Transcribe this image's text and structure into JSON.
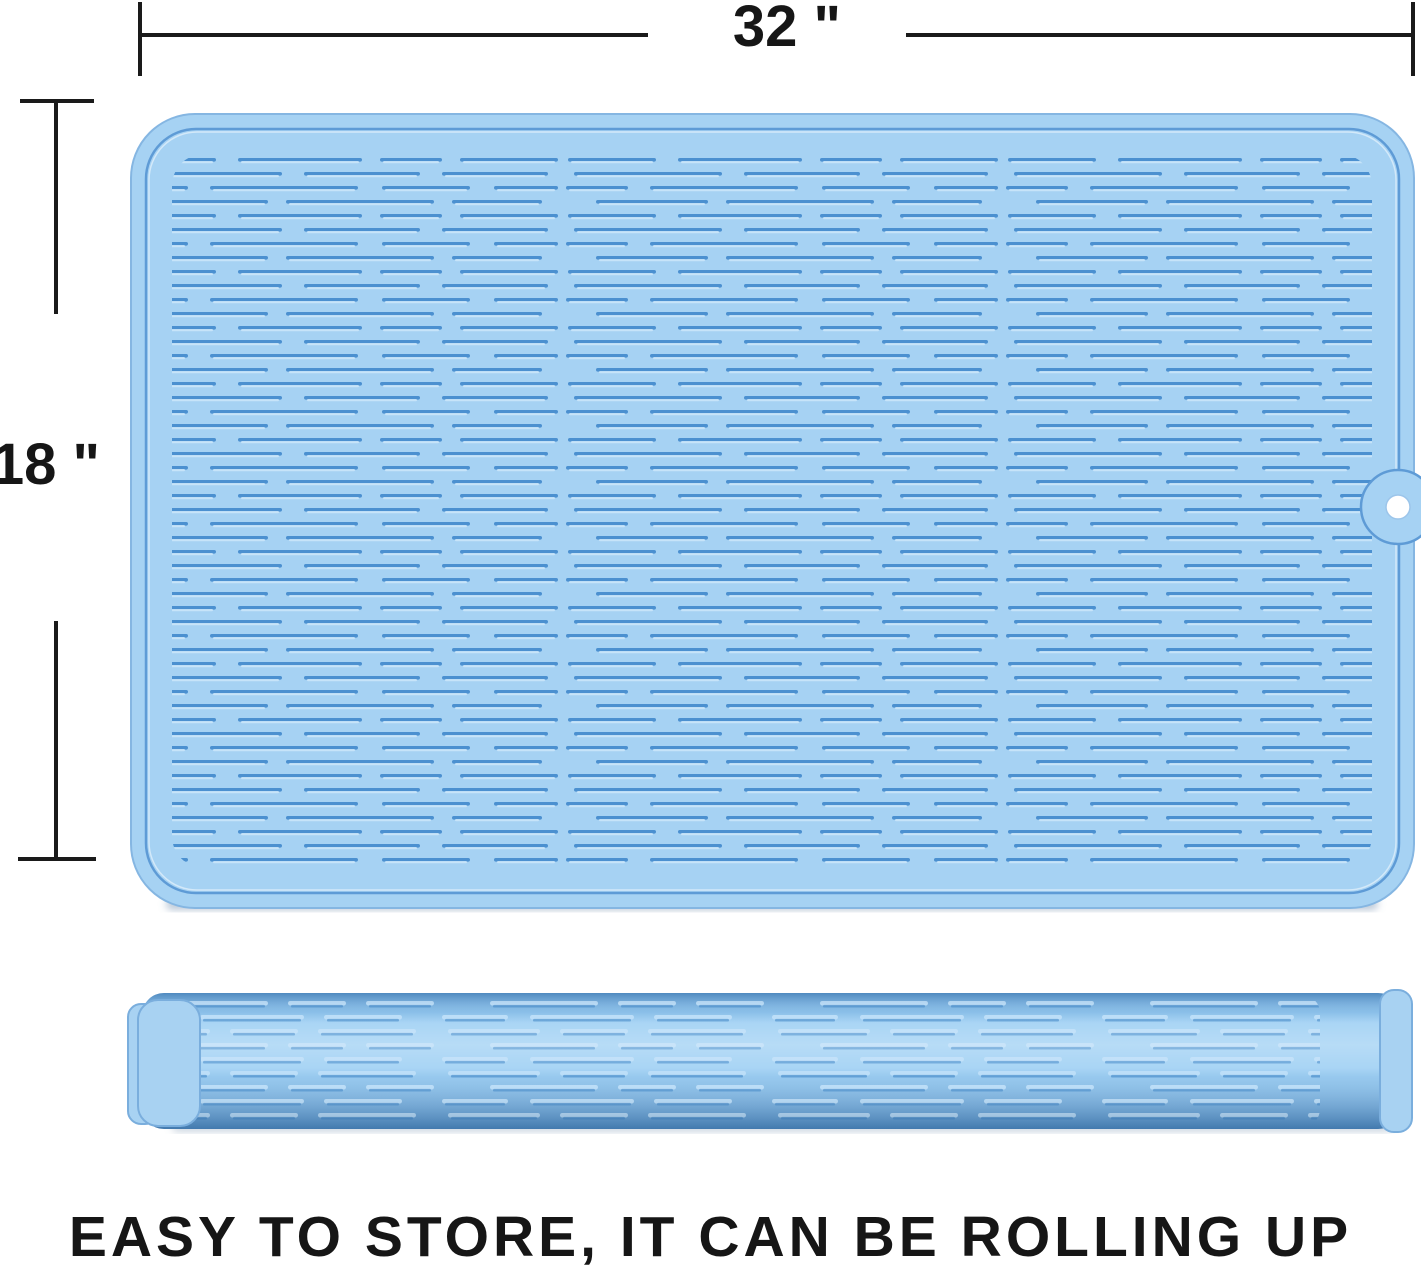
{
  "figure": {
    "width_label": "32 \"",
    "height_label": "18 \"",
    "caption": "EASY TO STORE, IT CAN BE ROLLING UP"
  },
  "colors": {
    "mat_fill": "#A6D2F3",
    "mat_edge": "#85B6E2",
    "inner_border": "#5E9BD6",
    "groove_dark": "#4B90D0",
    "groove_light": "#CDE8FB",
    "roll_top": "#5E9CD3",
    "roll_mid": "#A3D2F4",
    "roll_bottom": "#5694CC",
    "roll_dash_light": "#BADDF8",
    "roll_dash_shadow": "#3E86C6",
    "rim_fill": "#A8D2F2",
    "rim_edge": "#7AAEDD",
    "hole_fill": "#FFFFFF",
    "hole_ring": "#9CC5EA",
    "dimension_line": "#1A1A1A",
    "text": "#161616",
    "background": "#FFFFFF"
  }
}
